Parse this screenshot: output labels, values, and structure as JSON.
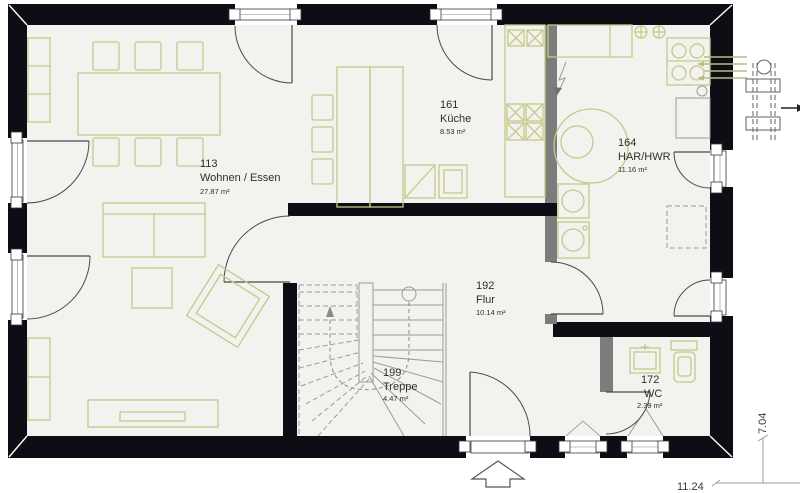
{
  "plan": {
    "colors": {
      "exterior_wall": "#0d0d15",
      "interior_wall": "#7c7c7c",
      "furniture_outline": "#c6c889",
      "floor": "#f2f2ef",
      "door_arc": "#4a4a4a"
    },
    "rooms": [
      {
        "number": "113",
        "name": "Wohnen / Essen",
        "area": "27.87 m²"
      },
      {
        "number": "161",
        "name": "Küche",
        "area": "8.53 m²"
      },
      {
        "number": "164",
        "name": "HAR/HWR",
        "area": "11.16 m²"
      },
      {
        "number": "192",
        "name": "Flur",
        "area": "10.14 m²"
      },
      {
        "number": "199",
        "name": "Treppe",
        "area": "4.47 m²"
      },
      {
        "number": "172",
        "name": "WC",
        "area": "2.39 m²"
      }
    ],
    "dimensions": {
      "width": "11.24",
      "height": "7.04"
    },
    "icons": {
      "entrance": "entrance-arrow",
      "outdoor_unit": "heat-pump-outdoor-unit",
      "stairs": "stair-walk-arrow",
      "electric": "electric-panel-arrow"
    }
  }
}
